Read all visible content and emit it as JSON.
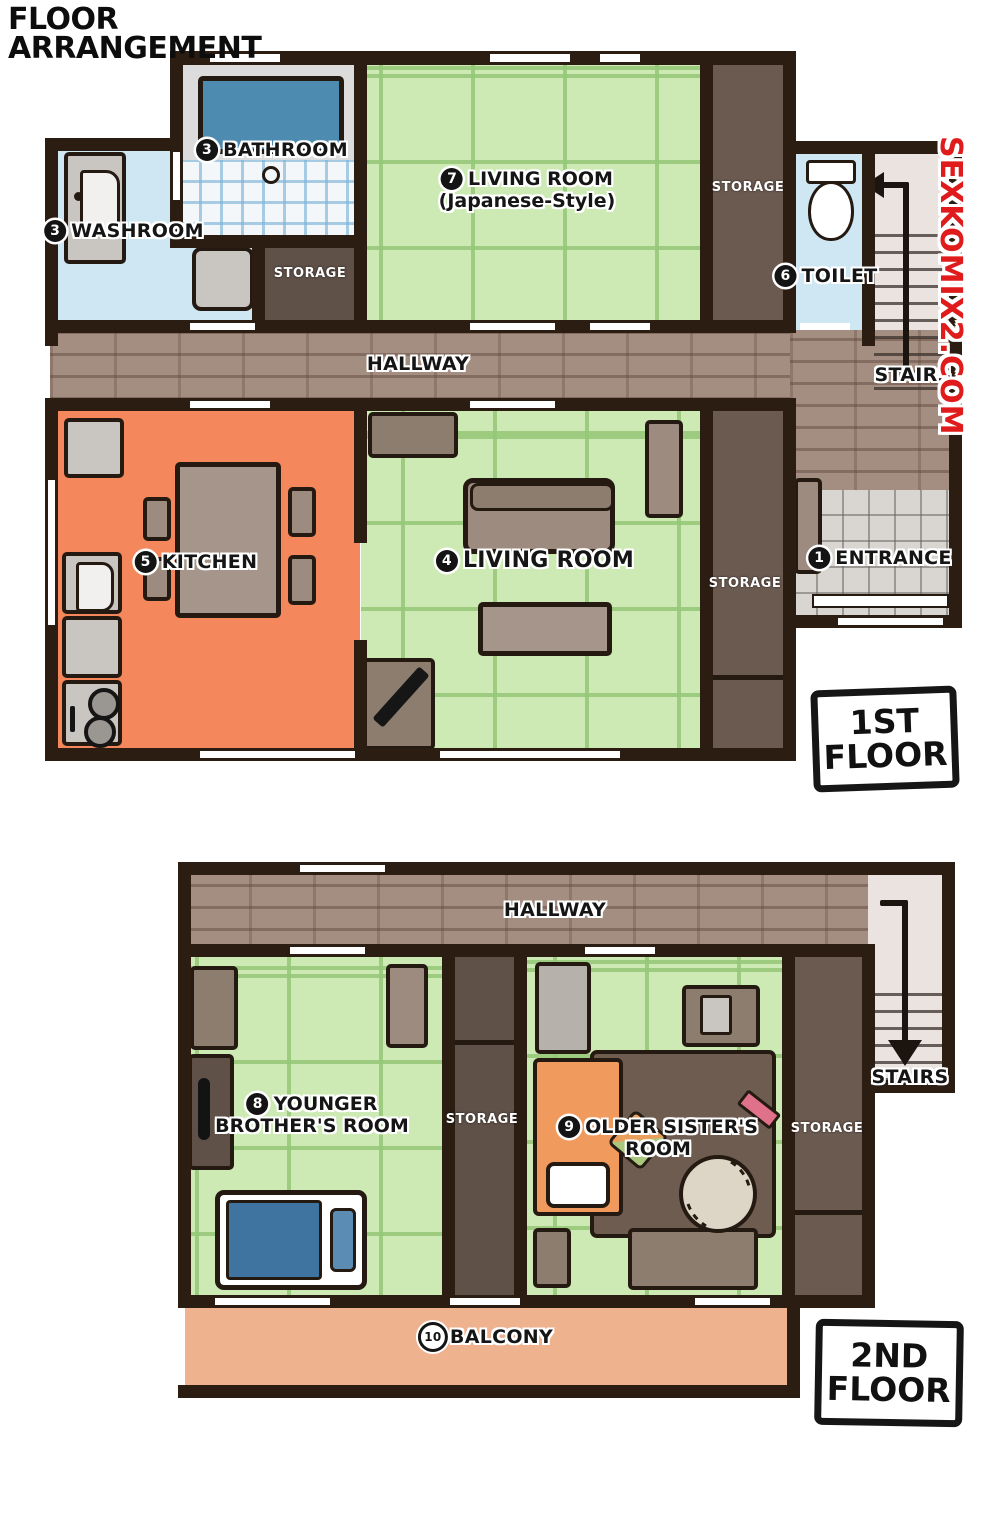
{
  "title": {
    "line1": "FLOOR",
    "line2": "ARRANGEMENT"
  },
  "watermark": "SEXKOMIX2.COM",
  "shared": {
    "storage": "STORAGE",
    "hallway": "HALLWAY",
    "stairs": "STAIRS"
  },
  "floor1": {
    "badge": {
      "line1": "1ST",
      "line2": "FLOOR"
    },
    "entrance": {
      "num": "1",
      "label": "ENTRANCE"
    },
    "washroom": {
      "num": "3",
      "label": "WASHROOM"
    },
    "bathroom": {
      "num": "3",
      "label": "BATHROOM"
    },
    "living_room": {
      "num": "4",
      "label": "LIVING ROOM"
    },
    "kitchen": {
      "num": "5",
      "label": "KITCHEN"
    },
    "toilet": {
      "num": "6",
      "label": "TOILET"
    },
    "living_room_jp": {
      "num": "7",
      "label": "LIVING ROOM",
      "sub": "(Japanese-Style)"
    }
  },
  "floor2": {
    "badge": {
      "line1": "2ND",
      "line2": "FLOOR"
    },
    "brother_room": {
      "num": "8",
      "line1": "YOUNGER",
      "line2": "BROTHER'S ROOM"
    },
    "sister_room": {
      "num": "9",
      "line1": "OLDER SISTER'S",
      "line2": "ROOM"
    },
    "balcony": {
      "num": "10",
      "label": "BALCONY"
    }
  },
  "colors": {
    "wall": "#2c1d13",
    "tatami_green": "#cde9b4",
    "kitchen_orange": "#f4875c",
    "water_blue": "#cfe7f3",
    "bathtub_blue": "#4e8bb0",
    "storage_brown": "#6b5a50",
    "hallway_brick": "#a38e81",
    "balcony_peach": "#eeb28f",
    "watermark_red": "#e01b1b"
  }
}
